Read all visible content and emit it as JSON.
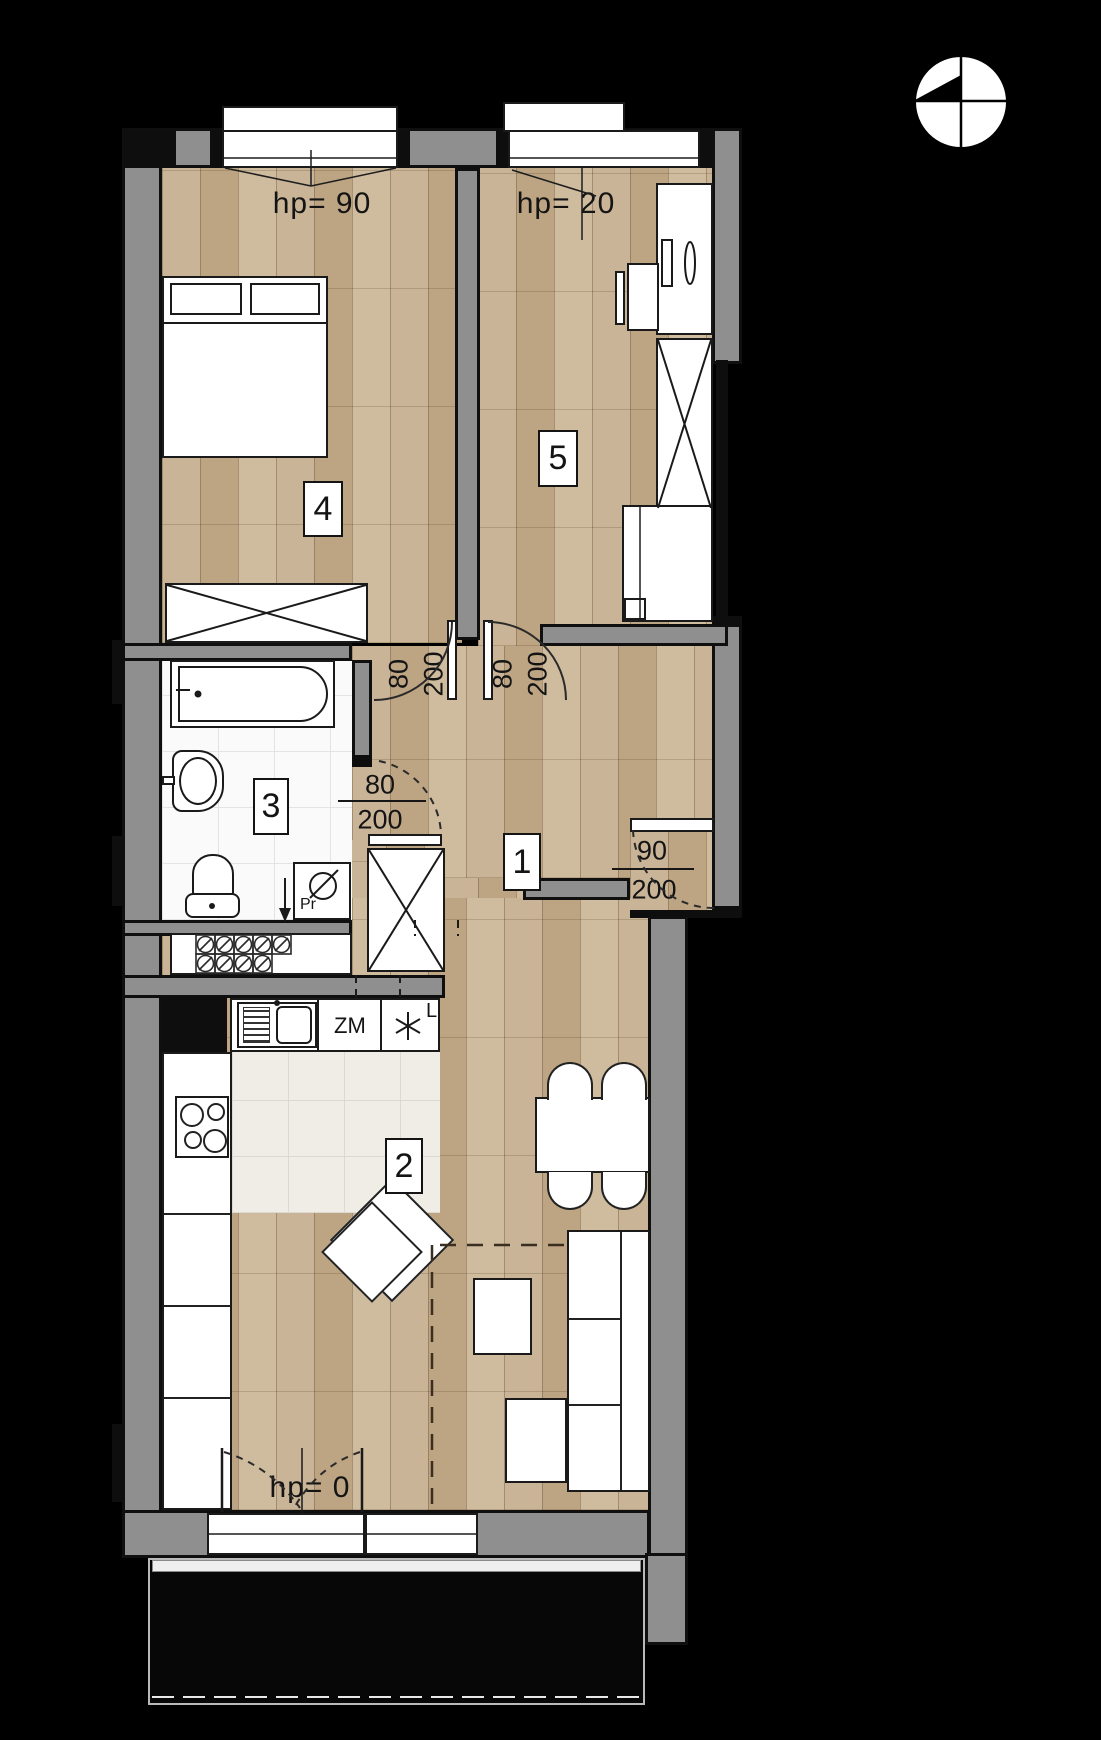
{
  "colors": {
    "wall": "#8f8f8f",
    "wood": "#c5ae90",
    "bath_tile": "#fafafa",
    "kitchen_tile": "#efede6",
    "ink": "#141414",
    "background": "#000000"
  },
  "labels": {
    "hp_top_left": "hp= 90",
    "hp_top_right": "hp= 20",
    "hp_bottom": "hp= 0"
  },
  "rooms": [
    {
      "number": "1"
    },
    {
      "number": "2"
    },
    {
      "number": "3"
    },
    {
      "number": "4"
    },
    {
      "number": "5"
    }
  ],
  "doors": {
    "room4": {
      "width": "80",
      "height": "200"
    },
    "room5": {
      "width": "80",
      "height": "200"
    },
    "bathroom": {
      "width": "80",
      "height": "200"
    },
    "entrance": {
      "width": "90",
      "height": "200"
    }
  },
  "kitchen": {
    "dishwasher_label": "ZM",
    "fridge_label": "L"
  },
  "bathroom_fixtures": {
    "washing_machine_label": "Pr"
  },
  "icons": {
    "north_arrow": "north-arrow-icon",
    "fridge_star": "six-point-star-icon",
    "vent_grille": "vent-grille-icon"
  }
}
